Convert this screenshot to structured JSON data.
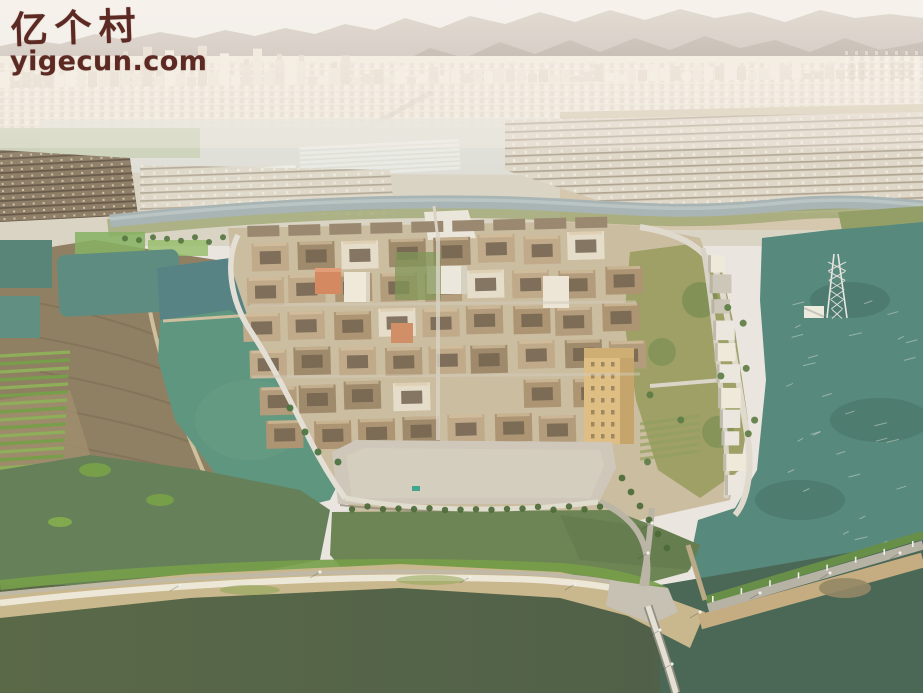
{
  "watermark": {
    "site_name": "亿个村",
    "site_url": "yigecun.com",
    "color": "#5d2a23"
  },
  "palette": {
    "sky": "#eceae6",
    "mountain_far": "#a79a8e",
    "mountain_near": "#8d7f74",
    "city": "#ece4d7",
    "field": "#d8d3c3",
    "dry_field": "#cdbfa2",
    "old_town": "#87765d",
    "canal": "#a3b2b2",
    "water_teal": "#4d8378",
    "water_green": "#55917b",
    "water_olive": "#5f7b50",
    "river_dark": "#4e6045",
    "roof": "#af9775",
    "roof_dark": "#9b8566",
    "courtyard": "#6b5c48",
    "plaza": "#ccc6b8",
    "road_light": "#e6e2d6",
    "road_grey": "#b2afa1",
    "levee": "#c6b488",
    "grass": "#7f9a4c",
    "tree": "#41632f",
    "building_white": "#ebe7dc",
    "building_yellow": "#dcbc7e",
    "building_orange": "#d2835a"
  }
}
